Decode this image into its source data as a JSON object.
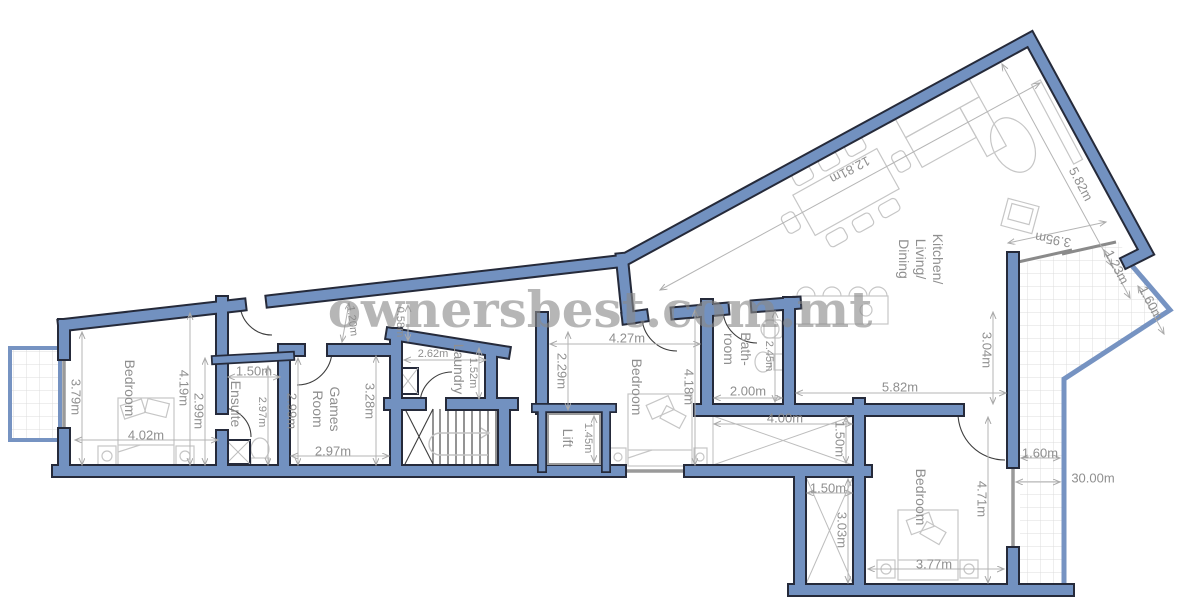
{
  "watermark": "ownersbest.com.mt",
  "colors": {
    "wall": "#7291c0",
    "outline": "#252a3a",
    "dim_text": "#8f8f8f",
    "watermark": "#8a8a8a"
  },
  "rooms": {
    "bedroom_left": "Bedroom",
    "ensuite": "Ensuite",
    "games_1": "Games",
    "games_2": "Room",
    "laundry": "Laundry",
    "lift": "Lift",
    "bedroom_mid": "Bedroom",
    "bath_1": "Bath-",
    "bath_2": "room",
    "kit_1": "Kitchen/",
    "kit_2": "Living/",
    "kit_3": "Dining",
    "bedroom_right": "Bedroom"
  },
  "dims": {
    "bl_left": "3.79m",
    "bl_mid": "4.19m",
    "bl_bed": "2.99m",
    "bl_width": "4.02m",
    "en_width": "1.50m",
    "en_depth": "2.97m",
    "gr_left": "2.99m",
    "gr_mid": "3.28m",
    "gr_width": "2.97m",
    "cor_a": "1.20m",
    "cor_b": "0.58m",
    "la_width": "2.62m",
    "la_depth": "1.52m",
    "lift_w": "1.45m",
    "bm_top": "4.27m",
    "bm_left": "2.29m",
    "bm_right": "4.18m",
    "ba_depth": "2.45m",
    "ba_width": "2.00m",
    "s1_w": "4.00m",
    "s1_d": "1.50m",
    "s2_w": "1.50m",
    "s2_d": "3.03m",
    "k_diag": "12.81m",
    "k_right": "5.82m",
    "k_glass": "3.95m",
    "k_n1": "1.23m",
    "k_n2": "1.60m",
    "k_bottom": "5.82m",
    "k_height": "3.04m",
    "br_height": "4.71m",
    "br_width": "3.77m",
    "t_strip": "1.60m",
    "t_len": "30.00m"
  }
}
